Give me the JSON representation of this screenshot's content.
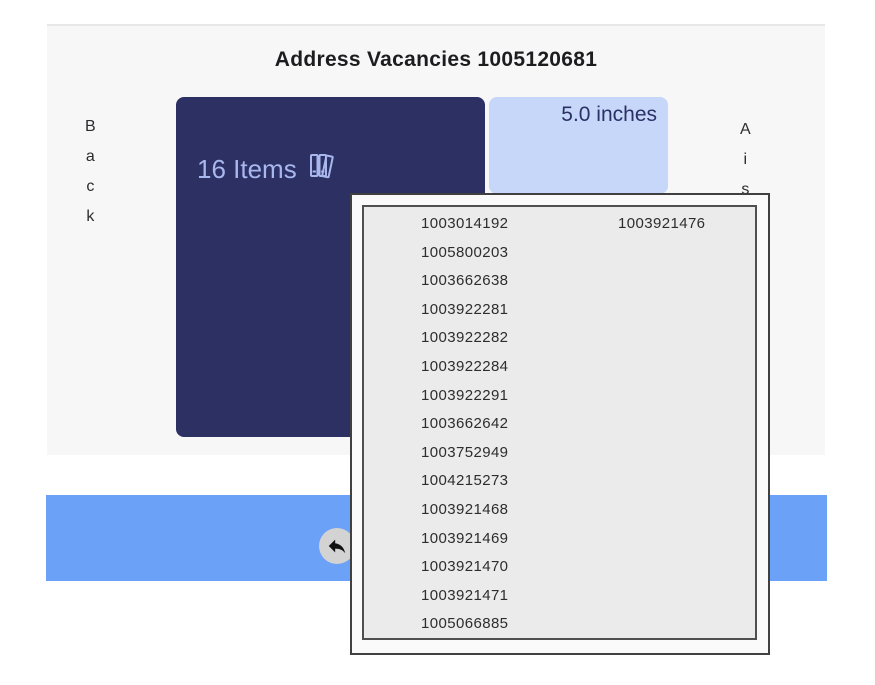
{
  "header": {
    "title": "Address Vacancies 1005120681"
  },
  "left_nav": {
    "label": "Back",
    "letters": [
      "B",
      "a",
      "c",
      "k"
    ]
  },
  "right_nav": {
    "label": "Aisle",
    "letters": [
      "A",
      "i",
      "s",
      "l",
      "e"
    ]
  },
  "shelf": {
    "items_card": {
      "label": "16 Items",
      "icon": "books-icon"
    },
    "vacancy_card": {
      "label": "5.0 inches"
    }
  },
  "popup": {
    "rows": [
      {
        "col1": "1003014192",
        "col2": "1003921476"
      },
      {
        "col1": "1005800203",
        "col2": ""
      },
      {
        "col1": "1003662638",
        "col2": ""
      },
      {
        "col1": "1003922281",
        "col2": ""
      },
      {
        "col1": "1003922282",
        "col2": ""
      },
      {
        "col1": "1003922284",
        "col2": ""
      },
      {
        "col1": "1003922291",
        "col2": ""
      },
      {
        "col1": "1003662642",
        "col2": ""
      },
      {
        "col1": "1003752949",
        "col2": ""
      },
      {
        "col1": "1004215273",
        "col2": ""
      },
      {
        "col1": "1003921468",
        "col2": ""
      },
      {
        "col1": "1003921469",
        "col2": ""
      },
      {
        "col1": "1003921470",
        "col2": ""
      },
      {
        "col1": "1003921471",
        "col2": ""
      },
      {
        "col1": "1005066885",
        "col2": ""
      }
    ]
  },
  "footer": {
    "back_button_icon": "reply-arrow-icon"
  },
  "colors": {
    "card_navy": "#2c3062",
    "card_text": "#a9b7ef",
    "vacancy_blue": "#c7d7f9",
    "vacancy_text": "#2b3166",
    "footer_blue": "#6ba1f6",
    "panel_gray": "#f7f7f8",
    "popup_gray": "#ebebeb",
    "button_gray": "#d3d3d3"
  }
}
